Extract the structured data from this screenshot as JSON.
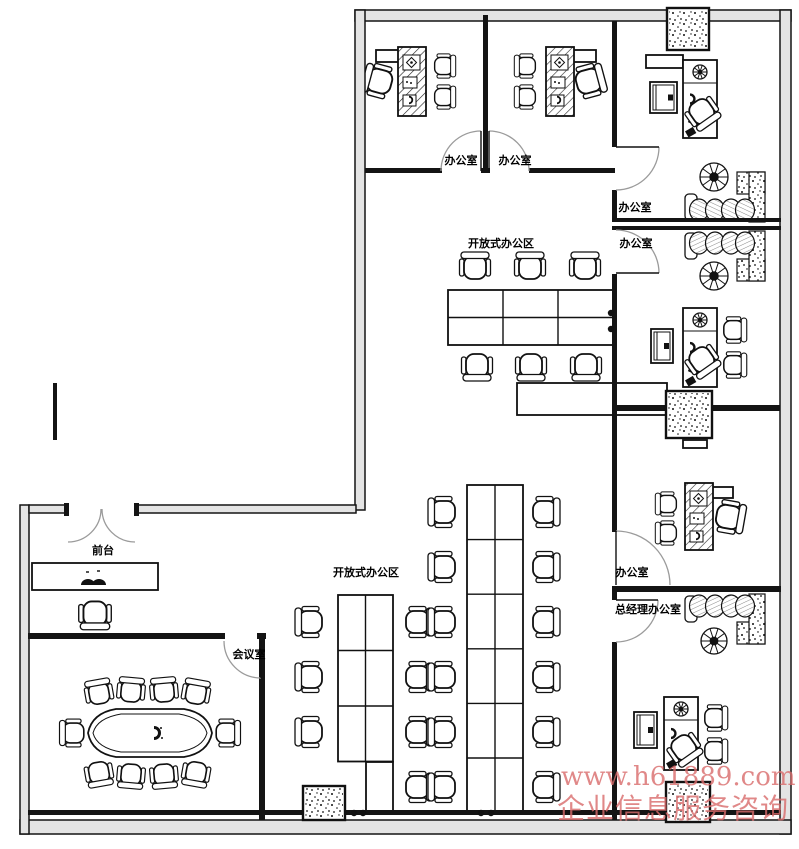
{
  "title": "办公室平面布置图",
  "watermark": {
    "line1": "www.h61889.com",
    "line2": "企业信息服务咨询",
    "color": "#d96b6b"
  },
  "plan": {
    "labels": [
      {
        "t": "办公室",
        "x": 461,
        "y": 164
      },
      {
        "t": "办公室",
        "x": 515,
        "y": 164
      },
      {
        "t": "办公室",
        "x": 635,
        "y": 211
      },
      {
        "t": "办公室",
        "x": 636,
        "y": 247
      },
      {
        "t": "开放式办公区",
        "x": 501,
        "y": 247
      },
      {
        "t": "开放式办公区",
        "x": 366,
        "y": 576
      },
      {
        "t": "办公室",
        "x": 632,
        "y": 576
      },
      {
        "t": "总经理办公室",
        "x": 648,
        "y": 613
      },
      {
        "t": "会议室",
        "x": 249,
        "y": 658
      },
      {
        "t": "前台",
        "x": 103,
        "y": 554
      }
    ],
    "walls_ext": [
      {
        "x": 355,
        "y": 10,
        "w": 436,
        "h": 11
      },
      {
        "x": 780,
        "y": 10,
        "w": 11,
        "h": 824
      },
      {
        "x": 20,
        "y": 820,
        "w": 771,
        "h": 14
      },
      {
        "x": 20,
        "y": 505,
        "w": 9,
        "h": 329
      },
      {
        "x": 355,
        "y": 10,
        "w": 10,
        "h": 500
      },
      {
        "x": 29,
        "y": 505,
        "w": 39,
        "h": 8
      },
      {
        "x": 135,
        "y": 505,
        "w": 221,
        "h": 8
      }
    ],
    "walls_int": [
      {
        "x": 365,
        "y": 168,
        "w": 77,
        "h": 5
      },
      {
        "x": 481,
        "y": 168,
        "w": 9,
        "h": 5
      },
      {
        "x": 529,
        "y": 168,
        "w": 86,
        "h": 5
      },
      {
        "x": 483,
        "y": 15,
        "w": 5,
        "h": 156
      },
      {
        "x": 612,
        "y": 21,
        "w": 5,
        "h": 126
      },
      {
        "x": 612,
        "y": 190,
        "w": 5,
        "h": 28
      },
      {
        "x": 612,
        "y": 218,
        "w": 169,
        "h": 4
      },
      {
        "x": 612,
        "y": 226,
        "w": 169,
        "h": 4
      },
      {
        "x": 612,
        "y": 274,
        "w": 5,
        "h": 258
      },
      {
        "x": 617,
        "y": 405,
        "w": 163,
        "h": 6
      },
      {
        "x": 612,
        "y": 586,
        "w": 169,
        "h": 6
      },
      {
        "x": 612,
        "y": 592,
        "w": 5,
        "h": 8
      },
      {
        "x": 612,
        "y": 642,
        "w": 5,
        "h": 178
      },
      {
        "x": 28,
        "y": 633,
        "w": 197,
        "h": 6
      },
      {
        "x": 257,
        "y": 633,
        "w": 9,
        "h": 6
      },
      {
        "x": 259,
        "y": 639,
        "w": 6,
        "h": 181
      },
      {
        "x": 28,
        "y": 810,
        "w": 753,
        "h": 5
      },
      {
        "x": 53,
        "y": 383,
        "w": 4,
        "h": 57
      },
      {
        "x": 64,
        "y": 503,
        "w": 5,
        "h": 13
      },
      {
        "x": 134,
        "y": 503,
        "w": 5,
        "h": 13
      }
    ],
    "doors": [
      {
        "d": "M481,131 A40,40 0 0 0 441,171",
        "leaf": [
          481,
          171,
          481,
          131
        ]
      },
      {
        "d": "M489,131 A40,40 0 0 1 529,171",
        "leaf": [
          489,
          171,
          489,
          131
        ]
      },
      {
        "d": "M659,147 A43,43 0 0 1 616,190",
        "leaf": [
          616,
          147,
          659,
          147
        ]
      },
      {
        "d": "M659,273 A43,43 0 0 0 616,230",
        "leaf": [
          616,
          273,
          659,
          273
        ]
      },
      {
        "d": "M616,531 A54,54 0 0 1 670,585",
        "leaf": [
          616,
          585,
          616,
          531
        ]
      },
      {
        "d": "M658,600 A42,42 0 0 1 616,642",
        "leaf": [
          616,
          600,
          658,
          600
        ]
      },
      {
        "d": "M224,641 A37,37 0 0 0 261,678",
        "leaf": [
          261,
          641,
          261,
          678
        ]
      },
      {
        "d": "M101,509 A33,33 0 0 1 68,542"
      },
      {
        "d": "M102,509 A33,33 0 0 0 135,542"
      }
    ],
    "columns": [
      {
        "x": 667,
        "y": 8,
        "w": 42,
        "h": 42
      },
      {
        "x": 666,
        "y": 391,
        "w": 46,
        "h": 47
      },
      {
        "x": 666,
        "y": 782,
        "w": 44,
        "h": 40
      },
      {
        "x": 303,
        "y": 786,
        "w": 42,
        "h": 34
      }
    ],
    "grids": [
      {
        "x": 448,
        "y": 290,
        "cols": 3,
        "rows": 2,
        "cw": 55,
        "rh": 27.5
      },
      {
        "x": 338,
        "y": 595,
        "cols": 2,
        "rows": 3,
        "cw": 27.5,
        "rh": 55.5
      },
      {
        "x": 366,
        "y": 762,
        "cols": 1,
        "rows": 1,
        "cw": 27,
        "rh": 50
      },
      {
        "x": 467,
        "y": 485,
        "cols": 2,
        "rows": 6,
        "cw": 28,
        "rh": 54.6
      }
    ],
    "shelves": [
      {
        "x": 517,
        "y": 383,
        "w": 150,
        "h": 32
      },
      {
        "x": 683,
        "y": 440,
        "w": 24,
        "h": 8
      },
      {
        "x": 646,
        "y": 55,
        "w": 37,
        "h": 13
      }
    ],
    "ldesks": [
      {
        "x": 398,
        "y": 47,
        "w": 28,
        "h": 69,
        "ret": {
          "x": 376,
          "y": 50,
          "w": 24,
          "h": 12
        }
      },
      {
        "x": 546,
        "y": 47,
        "w": 28,
        "h": 69,
        "ret": {
          "x": 572,
          "y": 50,
          "w": 24,
          "h": 12
        }
      },
      {
        "x": 685,
        "y": 483,
        "w": 28,
        "h": 67,
        "ret": {
          "x": 711,
          "y": 487,
          "w": 22,
          "h": 11
        }
      }
    ],
    "edesks": [
      {
        "x": 683,
        "y": 60,
        "w": 34,
        "h": 78
      },
      {
        "x": 683,
        "y": 308,
        "w": 34,
        "h": 79
      },
      {
        "x": 664,
        "y": 697,
        "w": 34,
        "h": 73
      }
    ],
    "cabinets": [
      {
        "x": 650,
        "y": 82,
        "w": 27,
        "h": 31
      },
      {
        "x": 651,
        "y": 329,
        "w": 22,
        "h": 34
      },
      {
        "x": 634,
        "y": 712,
        "w": 23,
        "h": 36
      }
    ],
    "sofas": [
      {
        "x": 685,
        "y": 168,
        "flip": false
      },
      {
        "x": 685,
        "y": 231,
        "flip": true
      },
      {
        "x": 685,
        "y": 594,
        "flip": true
      }
    ],
    "plants": [
      {
        "x": 714,
        "y": 177,
        "r": 14
      },
      {
        "x": 714,
        "y": 276,
        "r": 14
      },
      {
        "x": 714,
        "y": 641,
        "r": 13
      },
      {
        "x": 700,
        "y": 72,
        "r": 7
      },
      {
        "x": 700,
        "y": 320,
        "r": 7
      },
      {
        "x": 681,
        "y": 709,
        "r": 7
      }
    ],
    "conference": {
      "cx": 150,
      "cy": 733,
      "hw": 62,
      "hh": 26
    },
    "counter": {
      "x": 32,
      "y": 563,
      "w": 126,
      "h": 27
    },
    "chairs": [
      {
        "x": 475,
        "y": 267,
        "rot": 180
      },
      {
        "x": 530,
        "y": 267,
        "rot": 180
      },
      {
        "x": 585,
        "y": 267,
        "rot": 180
      },
      {
        "x": 477,
        "y": 366,
        "rot": 0
      },
      {
        "x": 531,
        "y": 366,
        "rot": 0
      },
      {
        "x": 586,
        "y": 366,
        "rot": 0
      },
      {
        "x": 379,
        "y": 81,
        "rot": 105,
        "s": 1.05
      },
      {
        "x": 444,
        "y": 66,
        "rot": -90,
        "s": 0.78
      },
      {
        "x": 444,
        "y": 97,
        "rot": -90,
        "s": 0.78
      },
      {
        "x": 589,
        "y": 81,
        "rot": -105,
        "s": 1.05
      },
      {
        "x": 526,
        "y": 66,
        "rot": 90,
        "s": 0.78
      },
      {
        "x": 526,
        "y": 97,
        "rot": 90,
        "s": 0.78
      },
      {
        "x": 702,
        "y": 112,
        "rot": -35,
        "s": 1
      },
      {
        "x": 702,
        "y": 360,
        "rot": -35,
        "s": 1
      },
      {
        "x": 734,
        "y": 330,
        "rot": -90,
        "s": 0.85
      },
      {
        "x": 734,
        "y": 365,
        "rot": -90,
        "s": 0.85
      },
      {
        "x": 729,
        "y": 517,
        "rot": -80,
        "s": 1.05
      },
      {
        "x": 667,
        "y": 504,
        "rot": 90,
        "s": 0.78
      },
      {
        "x": 667,
        "y": 533,
        "rot": 90,
        "s": 0.78
      },
      {
        "x": 684,
        "y": 748,
        "rot": -35,
        "s": 1
      },
      {
        "x": 715,
        "y": 718,
        "rot": -90,
        "s": 0.85
      },
      {
        "x": 715,
        "y": 751,
        "rot": -90,
        "s": 0.85
      },
      {
        "x": 310,
        "y": 622,
        "rot": 90
      },
      {
        "x": 310,
        "y": 677,
        "rot": 90
      },
      {
        "x": 310,
        "y": 732,
        "rot": 90
      },
      {
        "x": 418,
        "y": 622,
        "rot": -90
      },
      {
        "x": 443,
        "y": 622,
        "rot": 90
      },
      {
        "x": 418,
        "y": 677,
        "rot": -90
      },
      {
        "x": 443,
        "y": 677,
        "rot": 90
      },
      {
        "x": 418,
        "y": 732,
        "rot": -90
      },
      {
        "x": 443,
        "y": 732,
        "rot": 90
      },
      {
        "x": 418,
        "y": 787,
        "rot": -90
      },
      {
        "x": 443,
        "y": 787,
        "rot": 90
      },
      {
        "x": 443,
        "y": 512,
        "rot": 90
      },
      {
        "x": 443,
        "y": 567,
        "rot": 90
      },
      {
        "x": 545,
        "y": 512,
        "rot": -90
      },
      {
        "x": 545,
        "y": 567,
        "rot": -90
      },
      {
        "x": 545,
        "y": 622,
        "rot": -90
      },
      {
        "x": 545,
        "y": 677,
        "rot": -90
      },
      {
        "x": 545,
        "y": 732,
        "rot": -90
      },
      {
        "x": 545,
        "y": 787,
        "rot": -90
      },
      {
        "x": 95,
        "y": 614,
        "rot": 0,
        "s": 1.05
      },
      {
        "x": 99,
        "y": 693,
        "rot": 170,
        "s": 0.9
      },
      {
        "x": 131,
        "y": 691,
        "rot": 185,
        "s": 0.9
      },
      {
        "x": 164,
        "y": 691,
        "rot": 175,
        "s": 0.9
      },
      {
        "x": 196,
        "y": 693,
        "rot": 190,
        "s": 0.9
      },
      {
        "x": 99,
        "y": 773,
        "rot": -10,
        "s": 0.9
      },
      {
        "x": 131,
        "y": 775,
        "rot": 5,
        "s": 0.9
      },
      {
        "x": 164,
        "y": 775,
        "rot": -5,
        "s": 0.9
      },
      {
        "x": 196,
        "y": 773,
        "rot": 10,
        "s": 0.9
      },
      {
        "x": 73,
        "y": 733,
        "rot": 90,
        "s": 0.9
      },
      {
        "x": 227,
        "y": 733,
        "rot": -90,
        "s": 0.9
      }
    ],
    "dots": [
      {
        "x": 354,
        "y": 813
      },
      {
        "x": 363,
        "y": 813
      },
      {
        "x": 481,
        "y": 813
      },
      {
        "x": 491,
        "y": 813
      },
      {
        "x": 611,
        "y": 313
      },
      {
        "x": 611,
        "y": 329
      }
    ]
  }
}
